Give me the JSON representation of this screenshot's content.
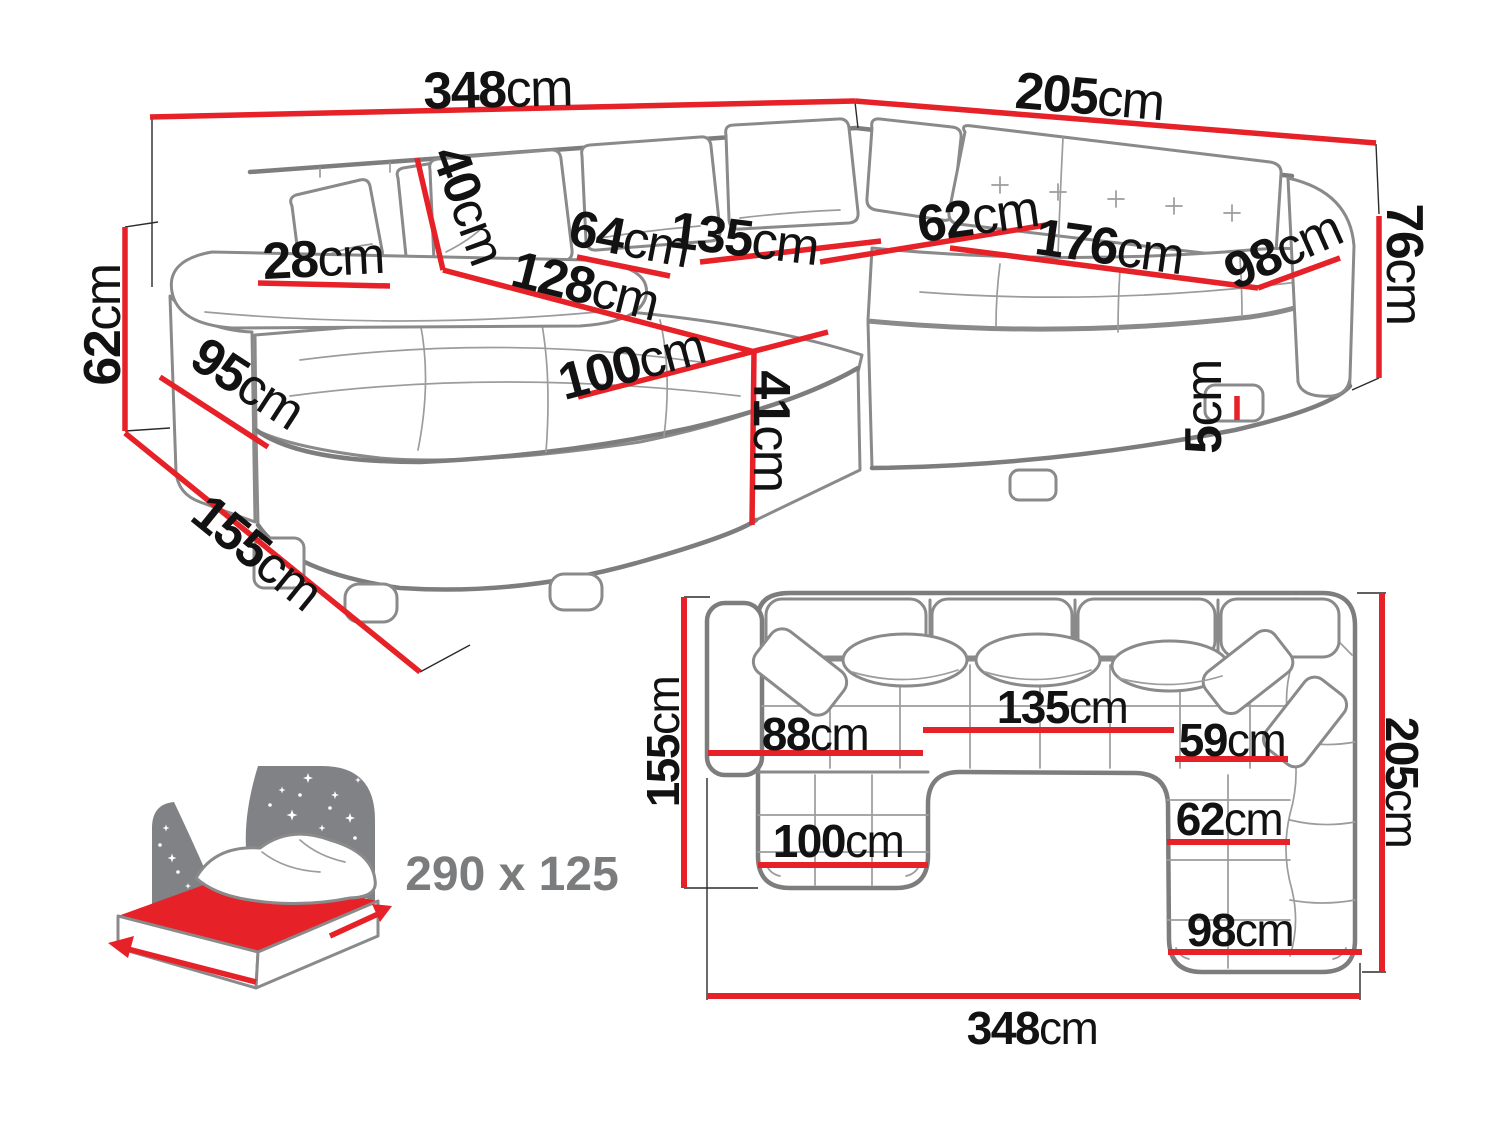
{
  "colors": {
    "red": "#e62128",
    "outline": "#7d7d7d",
    "sketch": "#9c9c9c",
    "ink": "#121212",
    "muted": "#7b7c7e",
    "bedgray": "#808285"
  },
  "persp": {
    "w348": {
      "v": "348",
      "u": "cm"
    },
    "w205": {
      "v": "205",
      "u": "cm"
    },
    "h40": {
      "v": "40",
      "u": "cm"
    },
    "w28": {
      "v": "28",
      "u": "cm"
    },
    "h62": {
      "v": "62",
      "u": "cm"
    },
    "d95": {
      "v": "95",
      "u": "cm"
    },
    "d155": {
      "v": "155",
      "u": "cm"
    },
    "l128": {
      "v": "128",
      "u": "cm"
    },
    "d64": {
      "v": "64",
      "u": "cm"
    },
    "w135": {
      "v": "135",
      "u": "cm"
    },
    "d62": {
      "v": "62",
      "u": "cm"
    },
    "w176": {
      "v": "176",
      "u": "cm"
    },
    "w98": {
      "v": "98",
      "u": "cm"
    },
    "h76": {
      "v": "76",
      "u": "cm"
    },
    "h5": {
      "v": "5",
      "u": "cm"
    },
    "w100": {
      "v": "100",
      "u": "cm"
    },
    "h41": {
      "v": "41",
      "u": "cm"
    }
  },
  "bed": {
    "label": "290 x 125"
  },
  "plan": {
    "d155": {
      "v": "155",
      "u": "cm"
    },
    "w88": {
      "v": "88",
      "u": "cm"
    },
    "w135": {
      "v": "135",
      "u": "cm"
    },
    "w59": {
      "v": "59",
      "u": "cm"
    },
    "w62": {
      "v": "62",
      "u": "cm"
    },
    "w100": {
      "v": "100",
      "u": "cm"
    },
    "w98": {
      "v": "98",
      "u": "cm"
    },
    "d205": {
      "v": "205",
      "u": "cm"
    },
    "w348": {
      "v": "348",
      "u": "cm"
    }
  }
}
